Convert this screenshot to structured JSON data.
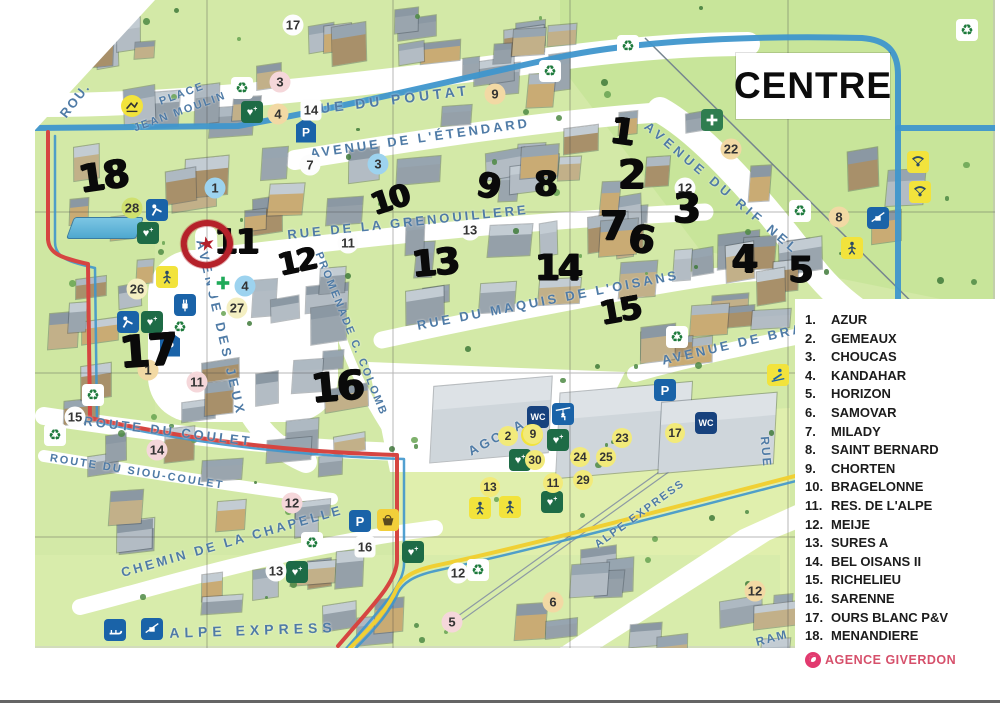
{
  "title": "CENTRE",
  "agency": "AGENCE GIVERDON",
  "legend": {
    "items": [
      {
        "num": "1.",
        "name": "AZUR"
      },
      {
        "num": "2.",
        "name": "GEMEAUX"
      },
      {
        "num": "3.",
        "name": "CHOUCAS"
      },
      {
        "num": "4.",
        "name": "KANDAHAR"
      },
      {
        "num": "5.",
        "name": "HORIZON"
      },
      {
        "num": "6.",
        "name": "SAMOVAR"
      },
      {
        "num": "7.",
        "name": "MILADY"
      },
      {
        "num": "8.",
        "name": "SAINT BERNARD"
      },
      {
        "num": "9.",
        "name": "CHORTEN"
      },
      {
        "num": "10.",
        "name": "BRAGELONNE"
      },
      {
        "num": "11.",
        "name": "RES. DE L'ALPE"
      },
      {
        "num": "12.",
        "name": "MEIJE"
      },
      {
        "num": "13.",
        "name": "SURES A"
      },
      {
        "num": "14.",
        "name": "BEL OISANS II"
      },
      {
        "num": "15.",
        "name": "RICHELIEU"
      },
      {
        "num": "16.",
        "name": "SARENNE"
      },
      {
        "num": "17.",
        "name": "OURS BLANC P&V"
      },
      {
        "num": "18.",
        "name": "MENANDIERE"
      }
    ]
  },
  "map": {
    "colors": {
      "route_blue": "#3f96cc",
      "route_red": "#d64541",
      "route_yellow": "#f0d034",
      "street_label": "#4f7ba6",
      "accent_pink": "#e23a6f"
    },
    "streets": [
      {
        "text": "ROU.",
        "x": 75,
        "y": 100,
        "rot": -52,
        "fs": 13,
        "ls": 2
      },
      {
        "text": "RUE DU POUTAT",
        "x": 388,
        "y": 100,
        "rot": -7,
        "fs": 14,
        "ls": 4
      },
      {
        "text": "PLACE",
        "x": 182,
        "y": 94,
        "rot": -20,
        "fs": 11,
        "ls": 2
      },
      {
        "text": "JEAN MOULIN",
        "x": 180,
        "y": 112,
        "rot": -20,
        "fs": 11,
        "ls": 2
      },
      {
        "text": "AVENUE DE L'ÉTENDARD",
        "x": 420,
        "y": 138,
        "rot": -8,
        "fs": 13,
        "ls": 3
      },
      {
        "text": "RUE DE LA GRENOUILLERE",
        "x": 408,
        "y": 222,
        "rot": -6,
        "fs": 13,
        "ls": 3
      },
      {
        "text": "RUE DU MAQUIS DE L'OISANS",
        "x": 548,
        "y": 300,
        "rot": -11,
        "fs": 13,
        "ls": 3
      },
      {
        "text": "AVENUE DU RIF NEL",
        "x": 722,
        "y": 188,
        "rot": 40,
        "fs": 13,
        "ls": 4
      },
      {
        "text": "AVENUE DE BRA",
        "x": 733,
        "y": 344,
        "rot": -13,
        "fs": 13,
        "ls": 3
      },
      {
        "text": "AVENUE DES JEUX",
        "x": 221,
        "y": 328,
        "rot": 77,
        "fs": 13,
        "ls": 4
      },
      {
        "text": "PROMENADE C. COLOMB",
        "x": 351,
        "y": 334,
        "rot": 68,
        "fs": 11,
        "ls": 2
      },
      {
        "text": "AGORA",
        "x": 497,
        "y": 437,
        "rot": -28,
        "fs": 13,
        "ls": 3
      },
      {
        "text": "ROUTE DU COULET",
        "x": 168,
        "y": 431,
        "rot": 7,
        "fs": 13,
        "ls": 3
      },
      {
        "text": "ROUTE DU SIOU-COULET",
        "x": 137,
        "y": 472,
        "rot": 9,
        "fs": 11,
        "ls": 2
      },
      {
        "text": "CHEMIN DE LA CHAPELLE",
        "x": 232,
        "y": 541,
        "rot": -16,
        "fs": 13,
        "ls": 3
      },
      {
        "text": "ALPE EXPRESS",
        "x": 253,
        "y": 630,
        "rot": -2,
        "fs": 14,
        "ls": 5
      },
      {
        "text": "ALPE EXPRESS",
        "x": 640,
        "y": 514,
        "rot": -36,
        "fs": 11,
        "ls": 2
      },
      {
        "text": "RUE",
        "x": 766,
        "y": 452,
        "rot": 85,
        "fs": 12,
        "ls": 2
      },
      {
        "text": "RAM",
        "x": 772,
        "y": 638,
        "rot": -15,
        "fs": 12,
        "ls": 2
      }
    ],
    "handwritten": [
      {
        "n": "18",
        "x": 103,
        "y": 176,
        "rot": -8,
        "s": 38
      },
      {
        "n": "17",
        "x": 148,
        "y": 351,
        "rot": -4,
        "s": 44
      },
      {
        "n": "11",
        "x": 236,
        "y": 242,
        "rot": 0,
        "s": 34
      },
      {
        "n": "12",
        "x": 297,
        "y": 262,
        "rot": -12,
        "s": 30
      },
      {
        "n": "16",
        "x": 337,
        "y": 387,
        "rot": -5,
        "s": 40
      },
      {
        "n": "10",
        "x": 390,
        "y": 200,
        "rot": -18,
        "s": 30
      },
      {
        "n": "13",
        "x": 435,
        "y": 263,
        "rot": -5,
        "s": 36
      },
      {
        "n": "9",
        "x": 488,
        "y": 186,
        "rot": 12,
        "s": 34
      },
      {
        "n": "8",
        "x": 545,
        "y": 184,
        "rot": 0,
        "s": 34
      },
      {
        "n": "14",
        "x": 558,
        "y": 268,
        "rot": 0,
        "s": 36
      },
      {
        "n": "15",
        "x": 620,
        "y": 310,
        "rot": -10,
        "s": 32
      },
      {
        "n": "1",
        "x": 622,
        "y": 132,
        "rot": 8,
        "s": 36
      },
      {
        "n": "2",
        "x": 631,
        "y": 175,
        "rot": 0,
        "s": 40
      },
      {
        "n": "3",
        "x": 686,
        "y": 209,
        "rot": 0,
        "s": 40
      },
      {
        "n": "7",
        "x": 613,
        "y": 226,
        "rot": 0,
        "s": 40
      },
      {
        "n": "6",
        "x": 641,
        "y": 239,
        "rot": 10,
        "s": 38
      },
      {
        "n": "4",
        "x": 744,
        "y": 259,
        "rot": 0,
        "s": 38
      },
      {
        "n": "5",
        "x": 800,
        "y": 270,
        "rot": 0,
        "s": 36
      }
    ],
    "badges": [
      {
        "n": "3",
        "x": 280,
        "y": 82,
        "c": "pink"
      },
      {
        "n": "17",
        "x": 293,
        "y": 25,
        "c": "white"
      },
      {
        "n": "4",
        "x": 278,
        "y": 114,
        "c": "tan"
      },
      {
        "n": "14",
        "x": 311,
        "y": 110,
        "c": "whitesq"
      },
      {
        "n": "9",
        "x": 495,
        "y": 94,
        "c": "tan"
      },
      {
        "n": "7",
        "x": 310,
        "y": 165,
        "c": "white"
      },
      {
        "n": "3",
        "x": 378,
        "y": 164,
        "c": "blue"
      },
      {
        "n": "11",
        "x": 348,
        "y": 243,
        "c": "white"
      },
      {
        "n": "13",
        "x": 470,
        "y": 230,
        "c": "white"
      },
      {
        "n": "12",
        "x": 685,
        "y": 188,
        "c": "white"
      },
      {
        "n": "22",
        "x": 731,
        "y": 149,
        "c": "tan"
      },
      {
        "n": "8",
        "x": 839,
        "y": 217,
        "c": "tan"
      },
      {
        "n": "1",
        "x": 215,
        "y": 188,
        "c": "blue"
      },
      {
        "n": "28",
        "x": 132,
        "y": 208,
        "c": "lime"
      },
      {
        "n": "26",
        "x": 137,
        "y": 289,
        "c": "cream"
      },
      {
        "n": "27",
        "x": 237,
        "y": 308,
        "c": "cream"
      },
      {
        "n": "4",
        "x": 245,
        "y": 286,
        "c": "blue"
      },
      {
        "n": "11",
        "x": 197,
        "y": 382,
        "c": "pink"
      },
      {
        "n": "1",
        "x": 148,
        "y": 370,
        "c": "tan"
      },
      {
        "n": "15",
        "x": 75,
        "y": 417,
        "c": "white"
      },
      {
        "n": "14",
        "x": 157,
        "y": 450,
        "c": "pink"
      },
      {
        "n": "12",
        "x": 292,
        "y": 503,
        "c": "pink"
      },
      {
        "n": "13",
        "x": 276,
        "y": 571,
        "c": "white"
      },
      {
        "n": "16",
        "x": 365,
        "y": 547,
        "c": "whitesq"
      },
      {
        "n": "12",
        "x": 458,
        "y": 573,
        "c": "white"
      },
      {
        "n": "13",
        "x": 490,
        "y": 487,
        "c": "yellow"
      },
      {
        "n": "2",
        "x": 508,
        "y": 436,
        "c": "yellow"
      },
      {
        "n": "9",
        "x": 533,
        "y": 434,
        "c": "yellow"
      },
      {
        "n": "23",
        "x": 622,
        "y": 438,
        "c": "yellow"
      },
      {
        "n": "17",
        "x": 675,
        "y": 433,
        "c": "yellow"
      },
      {
        "n": "30",
        "x": 535,
        "y": 460,
        "c": "yellow"
      },
      {
        "n": "24",
        "x": 580,
        "y": 457,
        "c": "yellow"
      },
      {
        "n": "25",
        "x": 606,
        "y": 457,
        "c": "yellow"
      },
      {
        "n": "11",
        "x": 553,
        "y": 483,
        "c": "yellow"
      },
      {
        "n": "29",
        "x": 583,
        "y": 480,
        "c": "yellow"
      },
      {
        "n": "5",
        "x": 452,
        "y": 622,
        "c": "pink"
      },
      {
        "n": "6",
        "x": 553,
        "y": 602,
        "c": "tan"
      },
      {
        "n": "12",
        "x": 755,
        "y": 591,
        "c": "tan"
      }
    ],
    "icons": [
      {
        "type": "recycle",
        "x": 242,
        "y": 88
      },
      {
        "type": "recycle",
        "x": 550,
        "y": 71
      },
      {
        "type": "recycle",
        "x": 628,
        "y": 46
      },
      {
        "type": "recycle",
        "x": 800,
        "y": 211
      },
      {
        "type": "recycle",
        "x": 677,
        "y": 337
      },
      {
        "type": "recycle",
        "x": 180,
        "y": 327
      },
      {
        "type": "recycle",
        "x": 93,
        "y": 395
      },
      {
        "type": "recycle",
        "x": 55,
        "y": 435
      },
      {
        "type": "recycle",
        "x": 312,
        "y": 543
      },
      {
        "type": "recycle",
        "x": 478,
        "y": 570
      },
      {
        "type": "recycle",
        "x": 967,
        "y": 30
      },
      {
        "type": "first-aid",
        "x": 252,
        "y": 112
      },
      {
        "type": "first-aid",
        "x": 148,
        "y": 233
      },
      {
        "type": "first-aid",
        "x": 152,
        "y": 322
      },
      {
        "type": "first-aid",
        "x": 297,
        "y": 572
      },
      {
        "type": "first-aid",
        "x": 558,
        "y": 440
      },
      {
        "type": "first-aid",
        "x": 520,
        "y": 460
      },
      {
        "type": "first-aid",
        "x": 552,
        "y": 502
      },
      {
        "type": "first-aid",
        "x": 413,
        "y": 552
      },
      {
        "type": "parking-pin",
        "x": 306,
        "y": 130
      },
      {
        "type": "parking-pin",
        "x": 170,
        "y": 344
      },
      {
        "type": "parking",
        "x": 665,
        "y": 390
      },
      {
        "type": "parking",
        "x": 360,
        "y": 521
      },
      {
        "type": "wc",
        "x": 538,
        "y": 417
      },
      {
        "type": "wc",
        "x": 706,
        "y": 423
      },
      {
        "type": "shop",
        "x": 388,
        "y": 520
      },
      {
        "type": "ski-lift",
        "x": 878,
        "y": 218
      },
      {
        "type": "ski-lift",
        "x": 152,
        "y": 629
      },
      {
        "type": "sledge",
        "x": 115,
        "y": 630
      },
      {
        "type": "chairlift-person",
        "x": 563,
        "y": 414
      },
      {
        "type": "ski-school",
        "x": 132,
        "y": 106
      },
      {
        "type": "ski-school",
        "x": 532,
        "y": 435
      },
      {
        "type": "medical",
        "x": 712,
        "y": 120
      },
      {
        "type": "pharmacy",
        "x": 223,
        "y": 283
      },
      {
        "type": "ev-charger",
        "x": 185,
        "y": 305
      },
      {
        "type": "playground",
        "x": 157,
        "y": 210
      },
      {
        "type": "playground",
        "x": 128,
        "y": 322
      },
      {
        "type": "activity",
        "x": 167,
        "y": 277
      },
      {
        "type": "activity",
        "x": 852,
        "y": 248
      },
      {
        "type": "activity",
        "x": 480,
        "y": 508
      },
      {
        "type": "activity",
        "x": 510,
        "y": 507
      },
      {
        "type": "skier",
        "x": 778,
        "y": 375
      },
      {
        "type": "paragliding",
        "x": 918,
        "y": 162
      },
      {
        "type": "paragliding",
        "x": 920,
        "y": 192
      }
    ],
    "marker": {
      "x": 207,
      "y": 244
    }
  }
}
